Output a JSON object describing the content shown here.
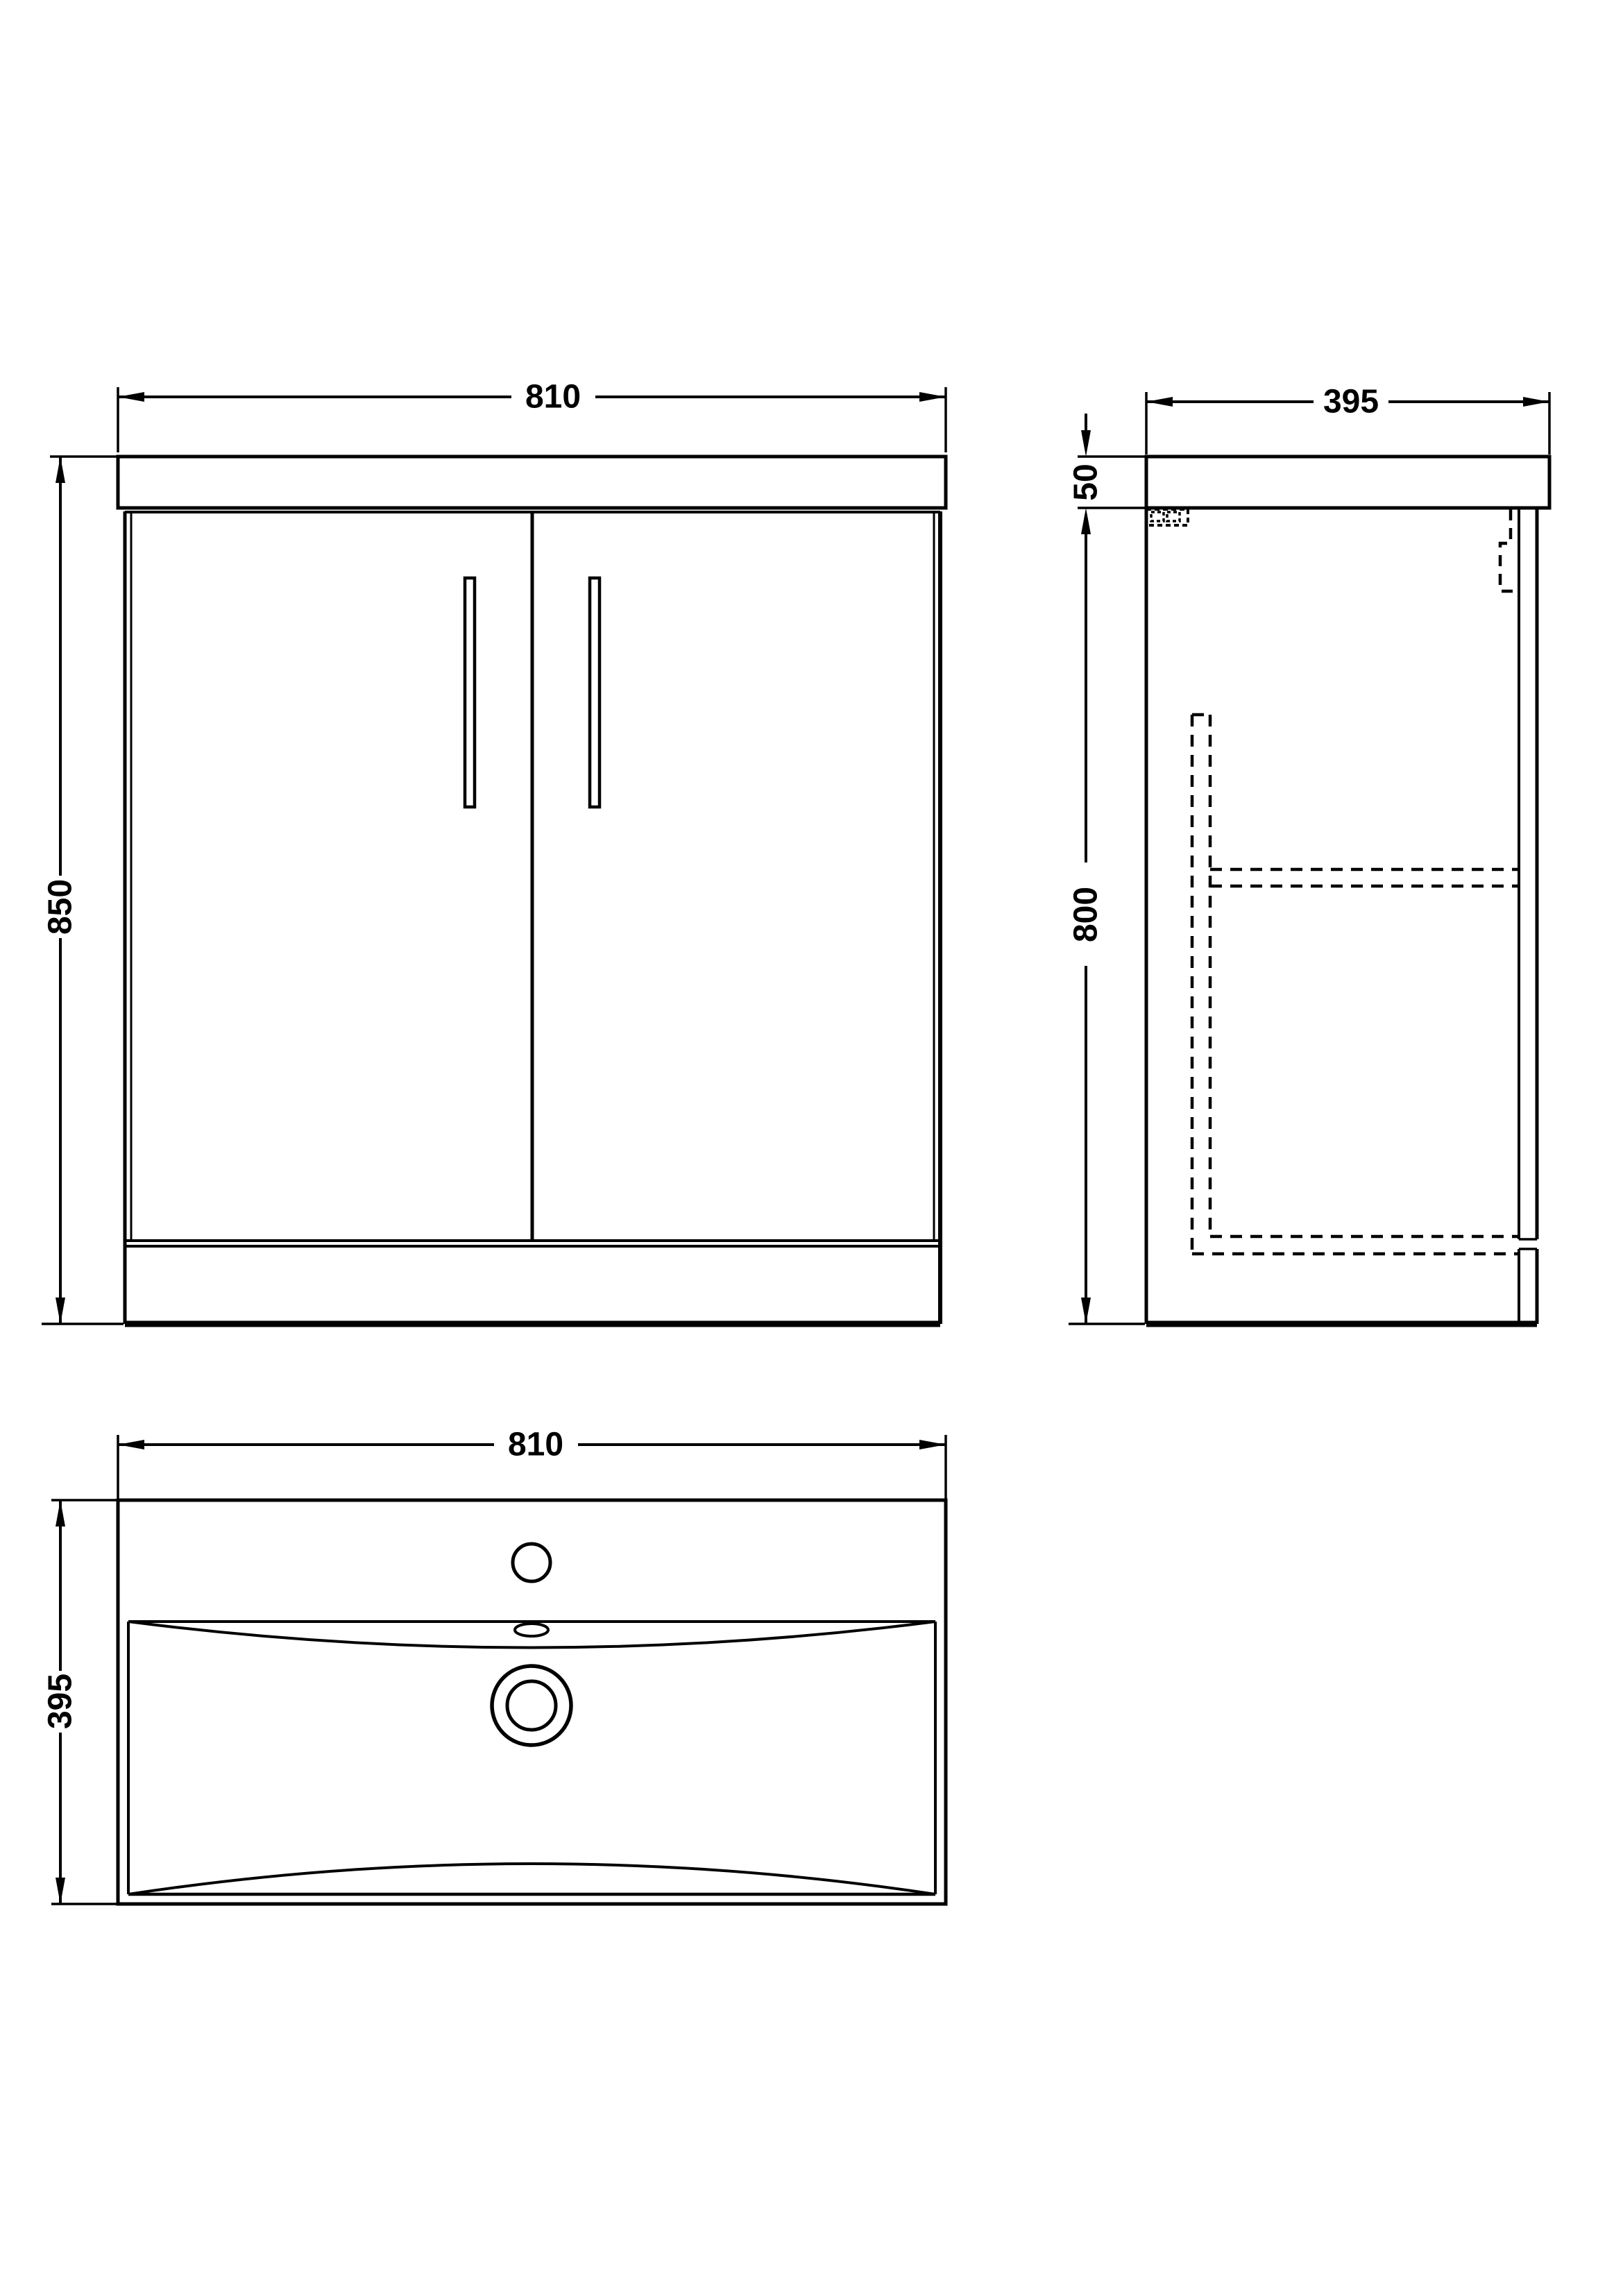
{
  "page": {
    "background_color": "#ffffff",
    "line_color": "#000000"
  },
  "dims": {
    "front_width": "810",
    "front_height": "850",
    "side_depth": "395",
    "worktop_thickness": "50",
    "cabinet_height": "800",
    "basin_width": "810",
    "basin_depth": "395"
  }
}
